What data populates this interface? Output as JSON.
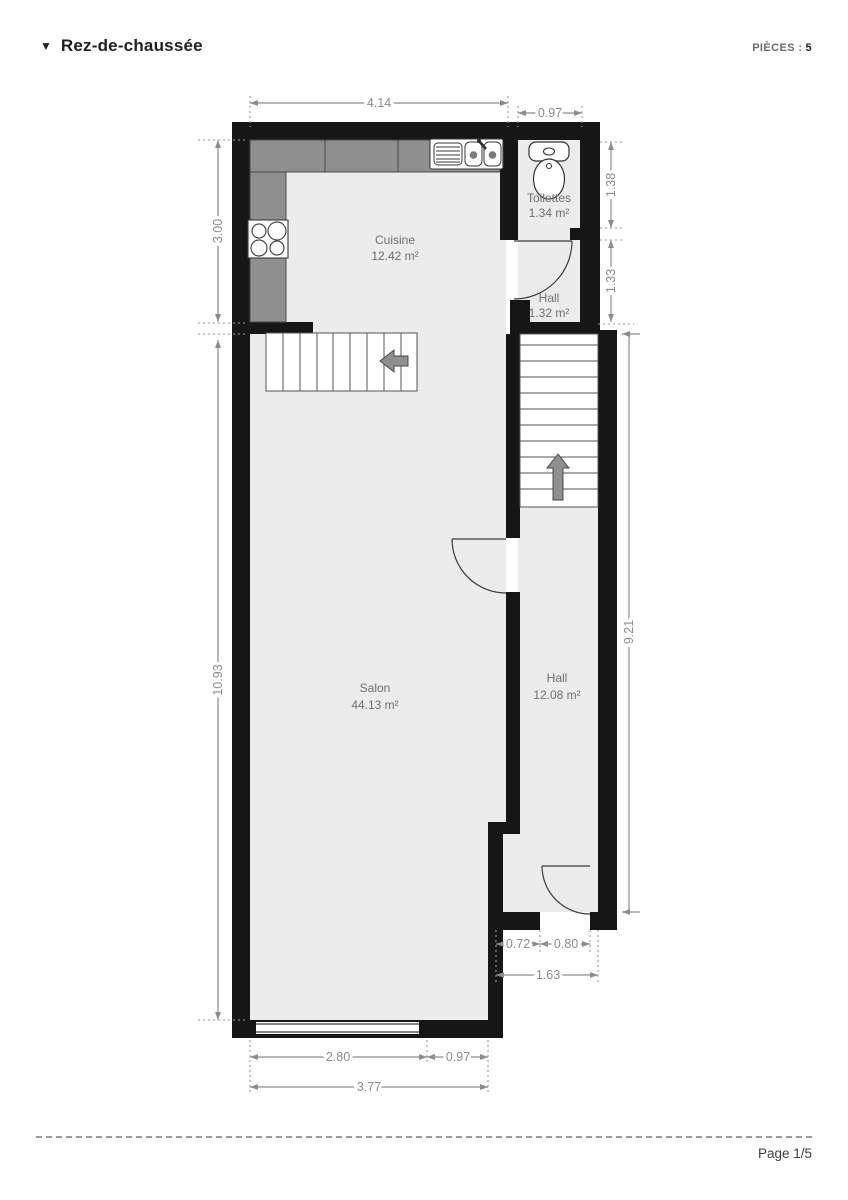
{
  "header": {
    "collapse_icon": "▼",
    "title": "Rez-de-chaussée",
    "rooms_label": "PIÈCES :",
    "rooms_count": "5"
  },
  "rooms": [
    {
      "name": "Cuisine",
      "area": "12.42 m²"
    },
    {
      "name": "Toilettes",
      "area": "1.34 m²"
    },
    {
      "name": "Hall",
      "area": "1.32 m²"
    },
    {
      "name": "Salon",
      "area": "44.13 m²"
    },
    {
      "name": "Hall",
      "area": "12.08 m²"
    }
  ],
  "dims": {
    "top_main": "4.14",
    "top_wc": "0.97",
    "left_kitchen": "3.00",
    "left_salon": "10.93",
    "right_wc": "1.38",
    "right_hall": "1.33",
    "right_corridor": "9.21",
    "door_offset": "0.72",
    "door_width": "0.80",
    "entry_total": "1.63",
    "window_width": "2.80",
    "bottom_right": "0.97",
    "bottom_total": "3.77"
  },
  "footer": {
    "page_label": "Page 1/5"
  },
  "colors": {
    "wall": "#161616",
    "room_fill": "#ececec",
    "counter": "#8f8f8f",
    "dimension": "#8c8c8c"
  }
}
